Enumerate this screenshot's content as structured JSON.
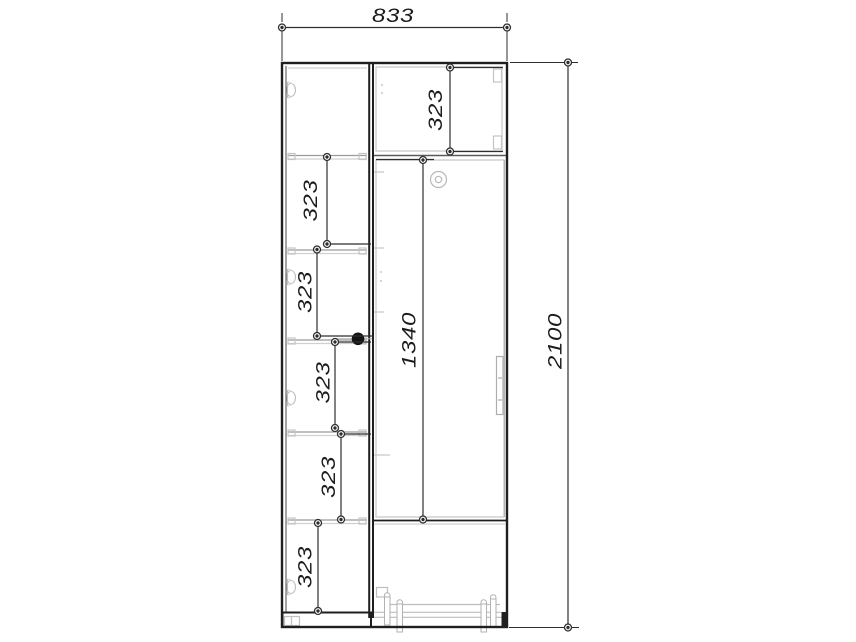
{
  "drawing": {
    "kind": "furniture-elevation",
    "colors": {
      "background": "#ffffff",
      "carcass_line": "#1f1f1f",
      "panel_line": "#c4c4c4",
      "dimension_line": "#2e2e2e",
      "text": "#1c1c1c",
      "shelf_pin_dot": "#141414"
    },
    "dims": {
      "overall_width": "833",
      "overall_height": "2100",
      "middle_door_height": "1340",
      "top_right_cell": "323",
      "left_cells": [
        "323",
        "323",
        "323",
        "323",
        "323"
      ]
    },
    "icons": {
      "hinge": "door-hinge-icon",
      "lock": "cam-lock-icon",
      "handle": "door-handle-icon",
      "leg": "adjustable-leg-icon",
      "shelf_pin": "shelf-pin-dot-icon"
    }
  }
}
